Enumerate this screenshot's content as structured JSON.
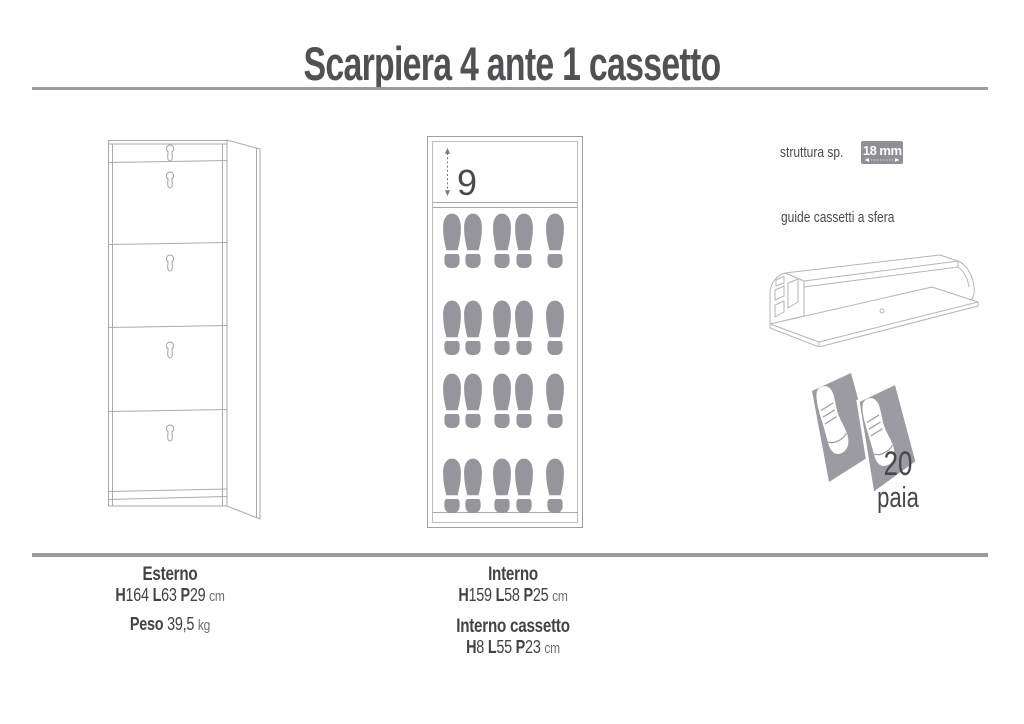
{
  "page": {
    "title": "Scarpiera 4 ante 1 cassetto"
  },
  "drawings": {
    "cabinet_front": "cabinet-exterior-line-drawing",
    "cabinet_interior": "cabinet-interior-capacity-drawing",
    "drawer_interior_height": "9",
    "footprint_rows": 4,
    "footprints_per_row": 5
  },
  "specs": {
    "thickness_label": "struttura sp.",
    "thickness_value": "18 mm",
    "guides_label": "guide cassetti a sfera",
    "capacity_value": "20",
    "capacity_unit": "paia"
  },
  "dimensions": {
    "esterno": {
      "heading": "Esterno",
      "parts": [
        {
          "key": "H",
          "val": "164"
        },
        {
          "key": "L",
          "val": "63"
        },
        {
          "key": "P",
          "val": "29"
        }
      ],
      "unit": "cm",
      "peso_label": "Peso",
      "peso_value": "39,5",
      "peso_unit": "kg"
    },
    "interno": {
      "heading": "Interno",
      "parts": [
        {
          "key": "H",
          "val": "159"
        },
        {
          "key": "L",
          "val": "58"
        },
        {
          "key": "P",
          "val": "25"
        }
      ],
      "unit": "cm"
    },
    "interno_cassetto": {
      "heading": "Interno cassetto",
      "parts": [
        {
          "key": "H",
          "val": "8"
        },
        {
          "key": "L",
          "val": "55"
        },
        {
          "key": "P",
          "val": "23"
        }
      ],
      "unit": "cm"
    }
  },
  "icons": {
    "footprint": "footprint-icon",
    "shoes": "shoe-pair-icon",
    "dimension_arrow": "dimension-arrow-icon",
    "drawer_guide": "drawer-guide-illustration"
  },
  "colors": {
    "badge_gray": "#8f8f95",
    "footprint_gray": "#95959b",
    "drawing_stroke": "#aaaaae",
    "rule_gray": "#9c9ca0",
    "text_dark": "#454548"
  }
}
